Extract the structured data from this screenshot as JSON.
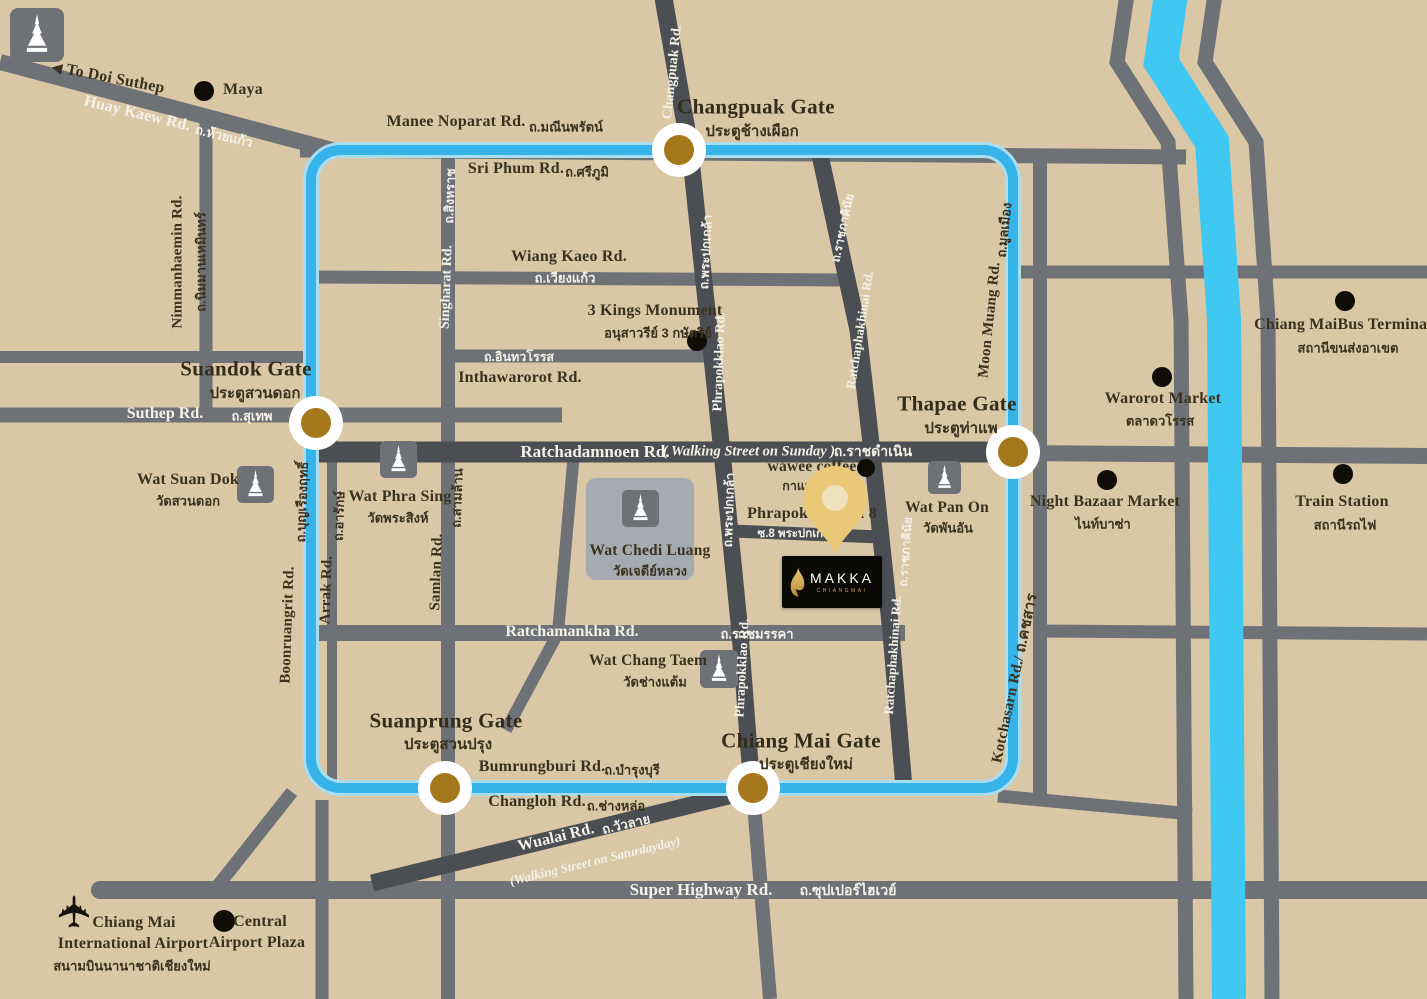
{
  "brand": {
    "name": "MAKKA",
    "sub": "CHIANGMAI"
  },
  "icons": {
    "west_arrow": "◀",
    "airplane": "✈"
  },
  "gates": {
    "changpuak": {
      "en": "Changpuak Gate",
      "th": "ประตูช้างเผือก"
    },
    "thapae": {
      "en": "Thapae Gate",
      "th": "ประตูท่าแพ"
    },
    "suandok": {
      "en": "Suandok Gate",
      "th": "ประตูสวนดอก"
    },
    "suanprung": {
      "en": "Suanprung Gate",
      "th": "ประตูสวนปรุง"
    },
    "chiangmai": {
      "en": "Chiang Mai Gate",
      "th": "ประตูเชียงใหม่"
    }
  },
  "roads": {
    "huay_kaew": {
      "en": "Huay Kaew Rd.",
      "th": "ถ.ห้วยแก้ว"
    },
    "manee_noparat": {
      "en": "Manee Noparat Rd.",
      "th": "ถ.มณีนพรัตน์"
    },
    "sri_phum": {
      "en": "Sri Phum Rd.",
      "th": "ถ.ศรีภูมิ"
    },
    "wiang_kaeo": {
      "en": "Wiang Kaeo Rd.",
      "th": "ถ.เวียงแก้ว"
    },
    "inthawarorot": {
      "en": "Inthawarorot Rd.",
      "th": "ถ.อินทวโรรส"
    },
    "nimmanhaemin": {
      "en": "Nimmanhaemin Rd.",
      "th": "ถ.นิมมานเหมินทร์"
    },
    "singharat": {
      "en": "Singharat Rd.",
      "th": "ถ.สิงหราช"
    },
    "samlan": {
      "en": "Samlan Rd.",
      "th": "ถ.สามล้าน"
    },
    "boonruangrit": {
      "en": "Boonruangrit Rd.",
      "th": "ถ.บุญเรืองฤทธิ์"
    },
    "arrak": {
      "en": "Arrak Rd.",
      "th": "ถ.อารักษ์"
    },
    "suthep": {
      "en": "Suthep Rd.",
      "th": "ถ.สุเทพ"
    },
    "changpuak_rd": {
      "en": "Changpuak Rd."
    },
    "phrapokklao": {
      "en": "Phrapokklao Rd.",
      "th": "ถ.พระปกเกล้า"
    },
    "ratchaphakhinai": {
      "en": "Ratchaphakhinai Rd.",
      "th": "ถ.ราชภาคินัย"
    },
    "moon_muang": {
      "en": "Moon Muang Rd.",
      "th": "ถ.มูลเมือง"
    },
    "kotchasarn": {
      "en": "Kotchasarn Rd./ ถ.คชสาร"
    },
    "ratchadamnoen": {
      "en": "Ratchadamnoen Rd.",
      "note": "( Walking Street on Sunday )",
      "th": "ถ.ราชดำเนิน"
    },
    "ratchamankha": {
      "en": "Ratchamankha Rd.",
      "th": "ถ.ราชมรรคา"
    },
    "bumrungburi": {
      "en": "Bumrungburi Rd.",
      "th": "ถ.บำรุงบุรี"
    },
    "changloh": {
      "en": "Changloh Rd.",
      "th": "ถ.ช่างหล่อ"
    },
    "wualai": {
      "en": "Wualai Rd.",
      "th": "ถ.วัวลาย",
      "note": "(Walking Street on Saturdayday)"
    },
    "super_highway": {
      "en": "Super Highway Rd.",
      "th": "ถ.ซุปเปอร์ไฮเวย์"
    },
    "soi8": {
      "en": "Phrapokklao Soi 8",
      "th": "ซ.8 พระปกเกล้า"
    }
  },
  "places": {
    "to_doi_suthep": "To Doi Suthep",
    "maya": "Maya",
    "three_kings": {
      "en": "3 Kings Monument",
      "th": "อนุสาวรีย์ 3 กษัตริย์"
    },
    "wawee": {
      "en": "wawee coffee",
      "th": "กาแฟ"
    },
    "warorot": {
      "en": "Warorot Market",
      "th": "ตลาดวโรรส"
    },
    "night_bazaar": {
      "en": "Night Bazaar Market",
      "th": "ไนท์บาซ่า"
    },
    "train_station": {
      "en": "Train Station",
      "th": "สถานีรถไฟ"
    },
    "bus_terminal": {
      "en": "Chiang MaiBus Terminal",
      "th": "สถานีขนส่งอาเขต"
    },
    "airport": {
      "line1": "Chiang Mai",
      "line2": "International Airport",
      "th": "สนามบินนานาชาติเชียงใหม่"
    },
    "central": {
      "line1": "Central",
      "line2": "Airport Plaza"
    }
  },
  "temples": {
    "wat_suan_dok": {
      "en": "Wat Suan Dok",
      "th": "วัดสวนดอก"
    },
    "wat_phra_sing": {
      "en": "Wat Phra Sing",
      "th": "วัดพระสิงห์"
    },
    "wat_chedi_luang": {
      "en": "Wat Chedi Luang",
      "th": "วัดเจดีย์หลวง"
    },
    "wat_pan_on": {
      "en": "Wat Pan On",
      "th": "วัดพันอัน"
    },
    "wat_chang_taem": {
      "en": "Wat Chang Taem",
      "th": "วัดช่างแต้ม"
    }
  },
  "colors": {
    "background": "#D9C7A6",
    "road": "#6E7277",
    "road_dark": "#4B4E52",
    "moat": "#36B3E8",
    "river": "#3FC8F2",
    "gate_center": "#A5791B",
    "pin": "#E9C878",
    "text": "#3A321F",
    "road_text": "#F4F1E8"
  }
}
